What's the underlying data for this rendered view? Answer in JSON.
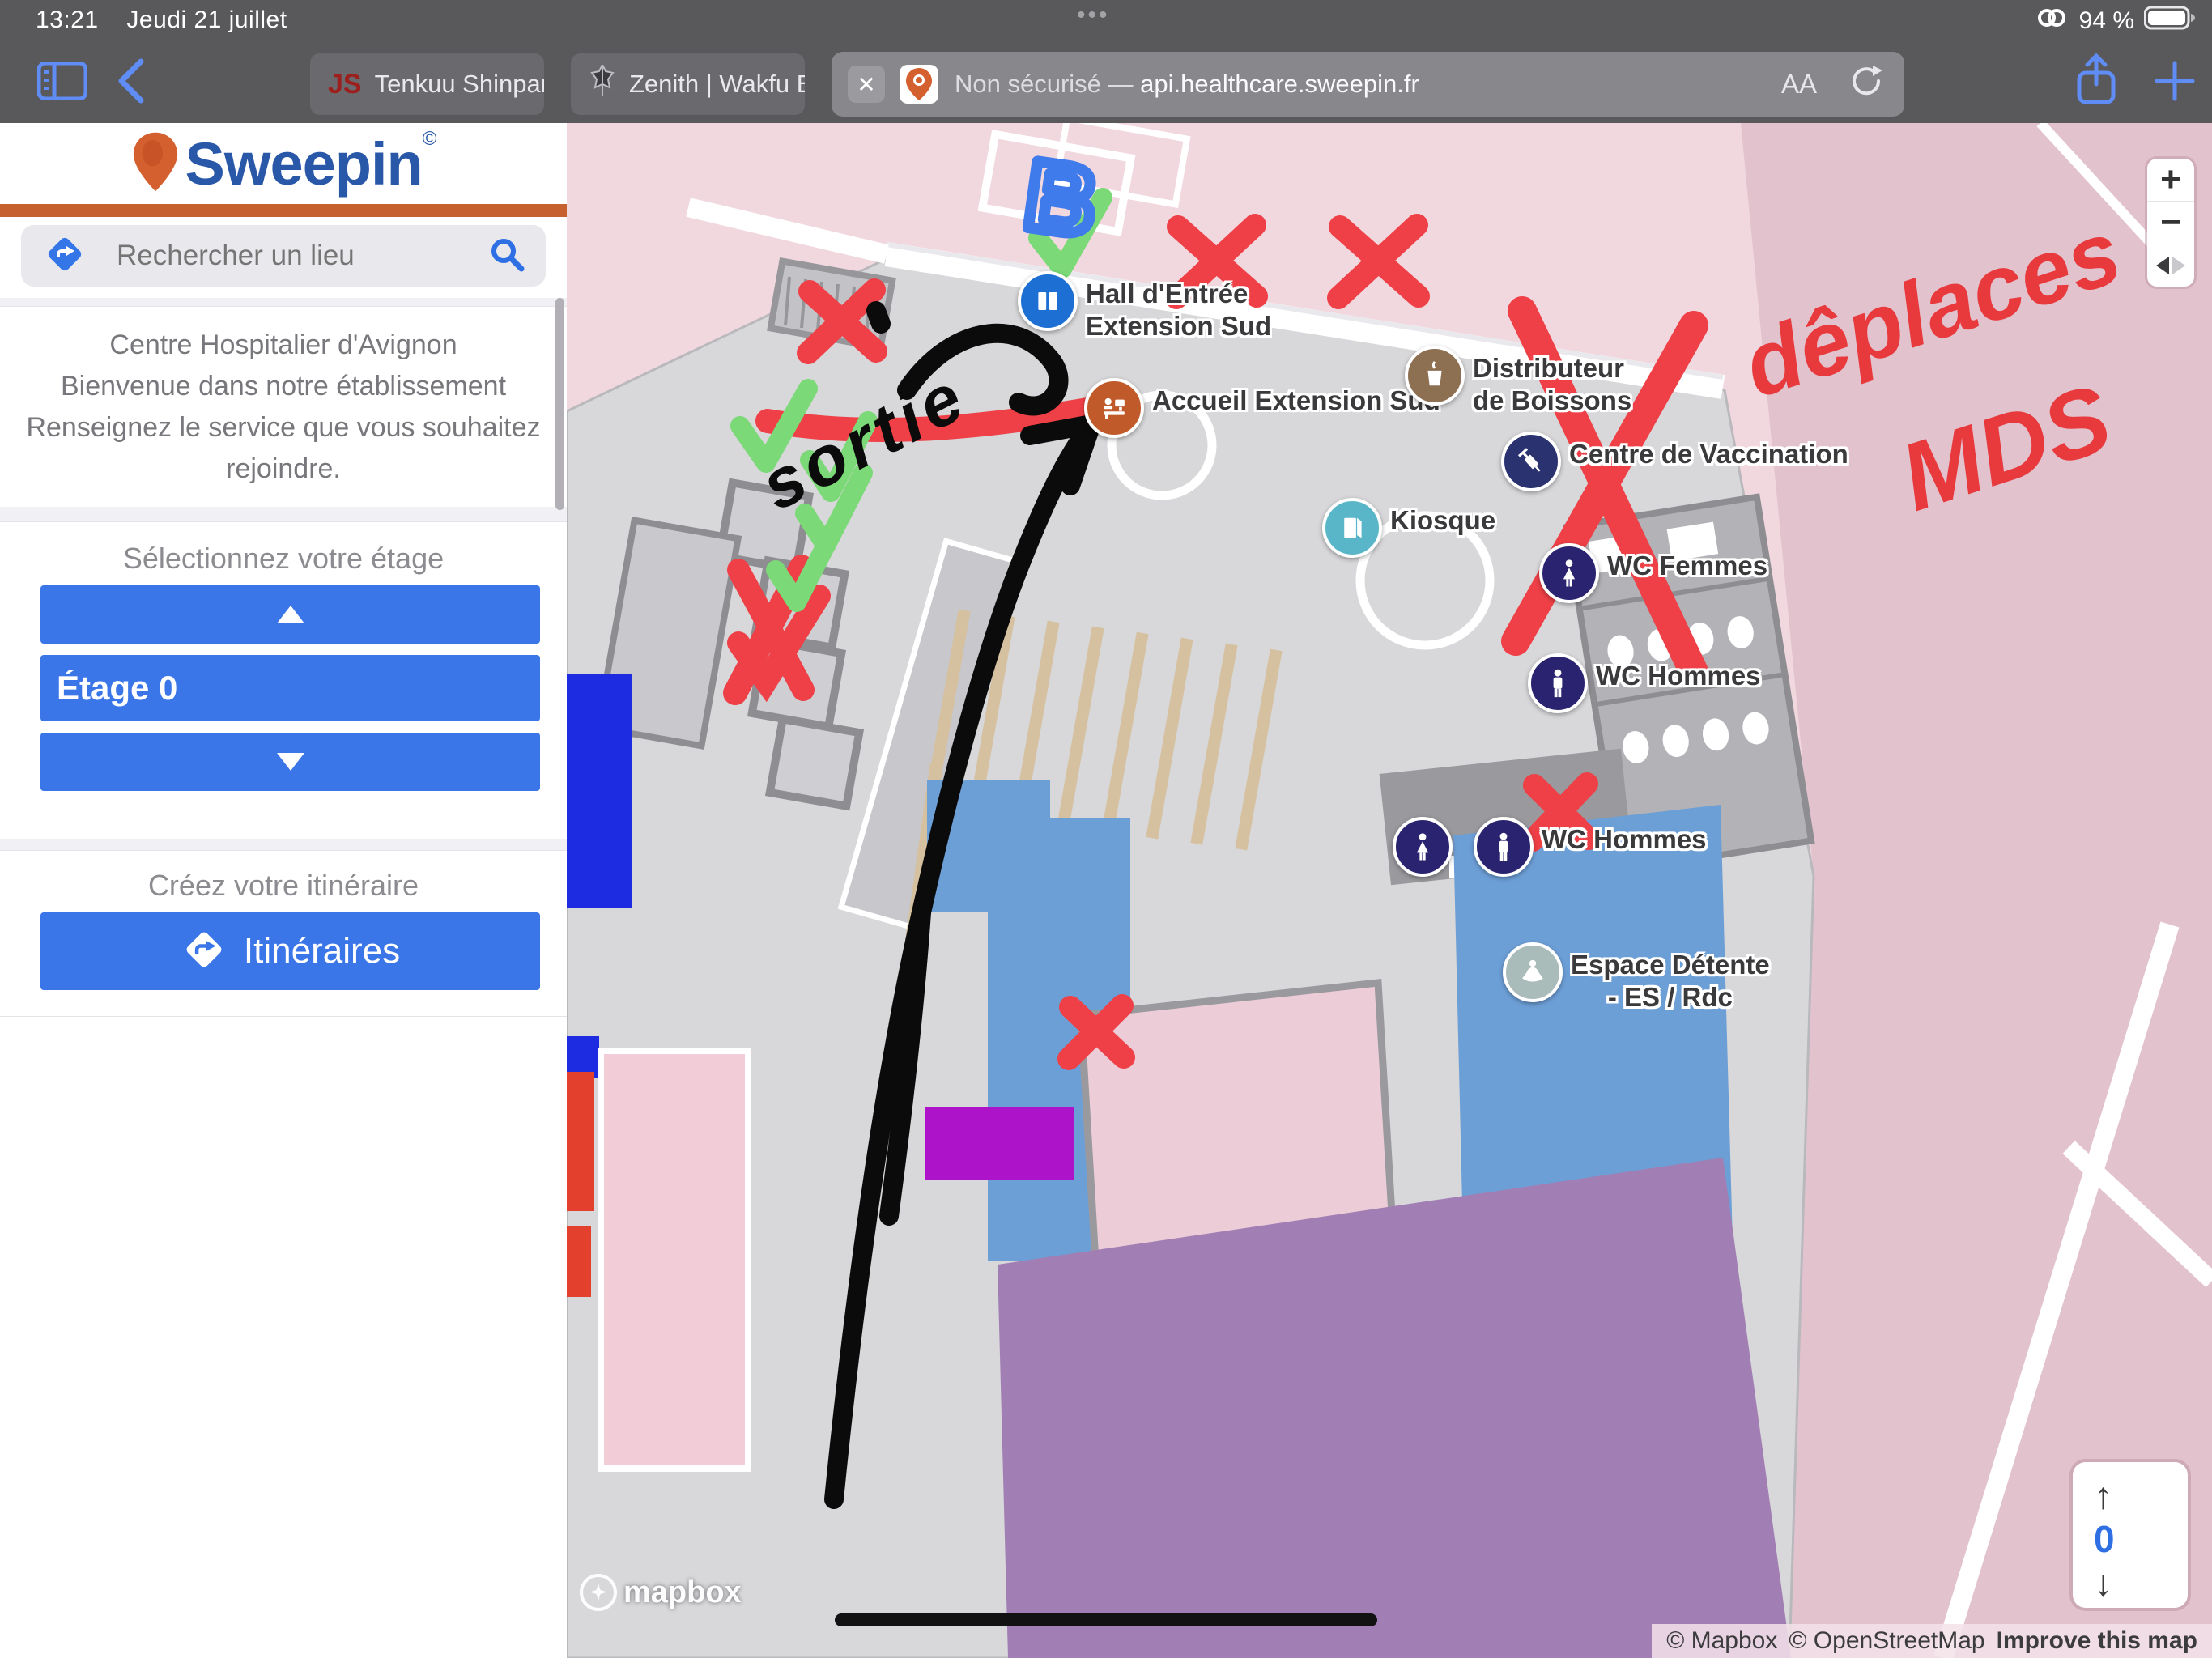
{
  "status_bar": {
    "time": "13:21",
    "date": "Jeudi 21 juillet",
    "battery_percent": "94 %"
  },
  "toolbar": {
    "tabs": [
      {
        "label": "Tenkuu Shinpan",
        "favicon_text": "JS"
      },
      {
        "label": "Zenith | Wakfu B"
      }
    ],
    "address": {
      "close_glyph": "✕",
      "security_label": "Non sécurisé — ",
      "url": "api.healthcare.sweepin.fr",
      "reader_label": "AA"
    }
  },
  "sidebar": {
    "brand": {
      "name": "Sweepin",
      "mark": "©"
    },
    "search": {
      "placeholder": "Rechercher un lieu"
    },
    "welcome": {
      "lines": [
        "Centre Hospitalier d'Avignon",
        "Bienvenue dans notre établissement",
        "Renseignez le service que vous souhaitez",
        "rejoindre."
      ]
    },
    "floor_selector": {
      "heading": "Sélectionnez votre étage",
      "current": "Étage 0"
    },
    "route": {
      "heading": "Créez votre itinéraire",
      "button_label": "Itinéraires"
    }
  },
  "map": {
    "pois": {
      "hall": {
        "line1": "Hall d'Entrée",
        "line2": "Extension Sud"
      },
      "accueil": {
        "label": "Accueil Extension Sud"
      },
      "distributeur": {
        "line1": "Distributeur",
        "line2": "de Boissons"
      },
      "vaccination": {
        "label": "Centre de Vaccination"
      },
      "kiosque": {
        "label": "Kiosque"
      },
      "wc_femmes": {
        "label": "WC Femmes"
      },
      "wc_hommes_upper": {
        "label": "WC Hommes"
      },
      "wc_hommes_lower": {
        "label": "WC Hommes"
      },
      "espace": {
        "line1": "Espace Détente",
        "line2": "- ES / Rdc"
      }
    },
    "annotations": {
      "sortie": "sortie",
      "deplaces": "dêplaces",
      "mds": "MDS",
      "letter_b": "B"
    },
    "floor_widget": {
      "up_glyph": "↑",
      "value": "0",
      "down_glyph": "↓"
    },
    "zoom_controls": {
      "zoom_in": "+",
      "zoom_out": "−"
    },
    "attribution": {
      "mapbox": "© Mapbox",
      "osm": "© OpenStreetMap",
      "improve": "Improve this map"
    },
    "logo_text": "mapbox"
  },
  "colors": {
    "accent_blue": "#3b76e9",
    "sweepin_orange": "#c6602f",
    "annotation_red": "#ee4046",
    "annotation_green": "#7bd977",
    "marker_navy": "#2a2370"
  }
}
